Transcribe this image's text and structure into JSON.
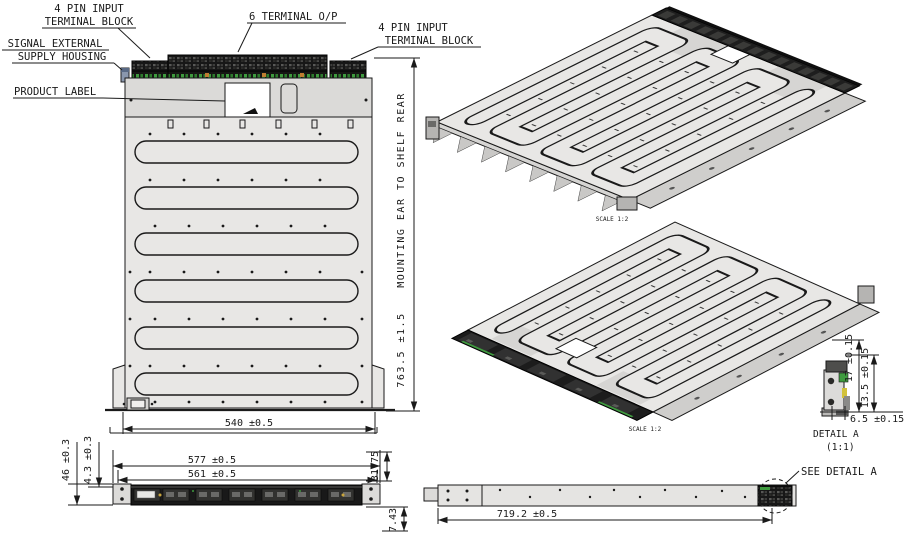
{
  "drawing": {
    "callouts": {
      "input_left_line1": "4 PIN INPUT",
      "input_left_line2": "TERMINAL BLOCK",
      "output_center": "6 TERMINAL O/P",
      "input_right_line1": "4 PIN INPUT",
      "input_right_line2": "TERMINAL BLOCK",
      "supply_line1": "SIGNAL EXTERNAL",
      "supply_line2": "SUPPLY HOUSING",
      "product_label": "PRODUCT LABEL"
    },
    "main_view": {
      "dim_width": "540 ±0.5",
      "dim_depth_value": "763.5 ±1.5",
      "dim_depth_note": "MOUNTING EAR TO SHELF REAR"
    },
    "iso_views": {
      "scale_top": "SCALE 1:2",
      "scale_bottom": "SCALE 1:2"
    },
    "front_view": {
      "dim_overall_width": "577 ±0.5",
      "dim_inner_width": "561 ±0.5",
      "dim_height": "46 ±0.3",
      "dim_flange": "4.3 ±0.3",
      "dim_ear_height": "31.75",
      "dim_under": "7.43"
    },
    "side_view": {
      "dim_length": "719.2 ±0.5",
      "note_detail": "SEE DETAIL A"
    },
    "detail_a": {
      "title": "DETAIL A",
      "scale": "(1:1)",
      "dim_height_outer": "17 ±0.15",
      "dim_height_inner": "13.5 ±0.15",
      "dim_width": "6.5 ±0.15"
    },
    "colors": {
      "chassis_gray": "#e8e7e5",
      "terminal_dark": "#1b1b1b",
      "connector_green": "#3f9b3f",
      "connector_orange": "#c07c30",
      "detail_yellow": "#d2c23c"
    }
  }
}
